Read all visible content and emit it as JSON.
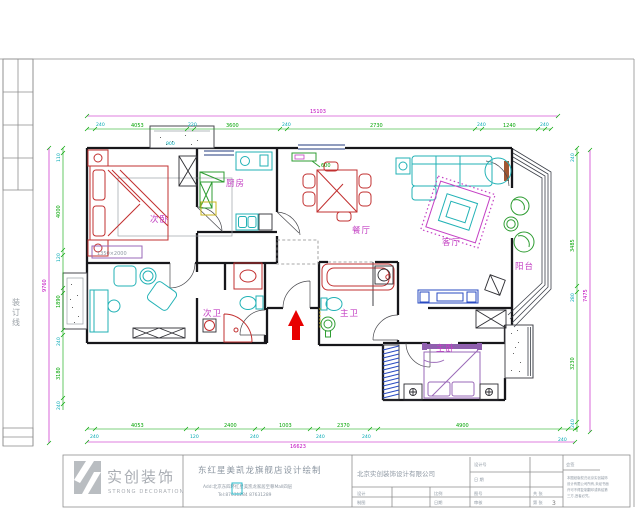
{
  "sheet": {
    "binding_chars": [
      "装",
      "订",
      "线"
    ],
    "logo": {
      "symbol": "S",
      "name_cn": "实创装饰",
      "name_en": "STRONG DECORATION"
    },
    "project": {
      "title": "东红星美凯龙旗舰店设计绘制",
      "address": "Add:北京东四环红星美凯龙家居至尊Mall四层",
      "tel": "Tel:87631284  87631289"
    },
    "title_block": {
      "company": "北京实创装饰设计有限公司",
      "field1": "设计号",
      "field2": "日 期",
      "design": "设计",
      "draft": "制图",
      "check": "审核",
      "scale": "比例",
      "date": "日期",
      "no": "图号",
      "total": "共 张",
      "page": "第 张",
      "page_no": "3",
      "sign": "会签",
      "notes": [
        "本图纸版权归北京实创装饰",
        "设计有限公司所有,未经书面",
        "许可不得复制翻印或转给第",
        "三方,违者必究。"
      ]
    }
  },
  "plan": {
    "rooms": {
      "bedroom2": "次卧",
      "kitchen": "厨房",
      "dining": "餐厅",
      "living": "客厅",
      "balcony": "阳台",
      "bath2": "次卫",
      "bath1": "主卫",
      "bedroom1": "主卧"
    },
    "dims": {
      "top_overall": "15103",
      "top_green": [
        "4053",
        "3600",
        "2730",
        "1240"
      ],
      "top_cyan": [
        "240",
        "220",
        "240",
        "240",
        "240"
      ],
      "bottom_overall": "16623",
      "bottom_green": [
        "4053",
        "2400",
        "1003",
        "2370",
        "4900"
      ],
      "bottom_cyan": [
        "240",
        "120",
        "240",
        "240",
        "240",
        "240"
      ],
      "left_overall": "9760",
      "left_green": [
        "4000",
        "1890",
        "3180"
      ],
      "left_cyan": [
        "110",
        "120",
        "240",
        "240"
      ],
      "right_overall": "7475",
      "right_green": [
        "3485",
        "3230"
      ],
      "right_cyan": [
        "240",
        "280",
        "240"
      ],
      "extra_window": "900",
      "extra_cabinet": "600",
      "bed_note": "1350×2000"
    }
  }
}
